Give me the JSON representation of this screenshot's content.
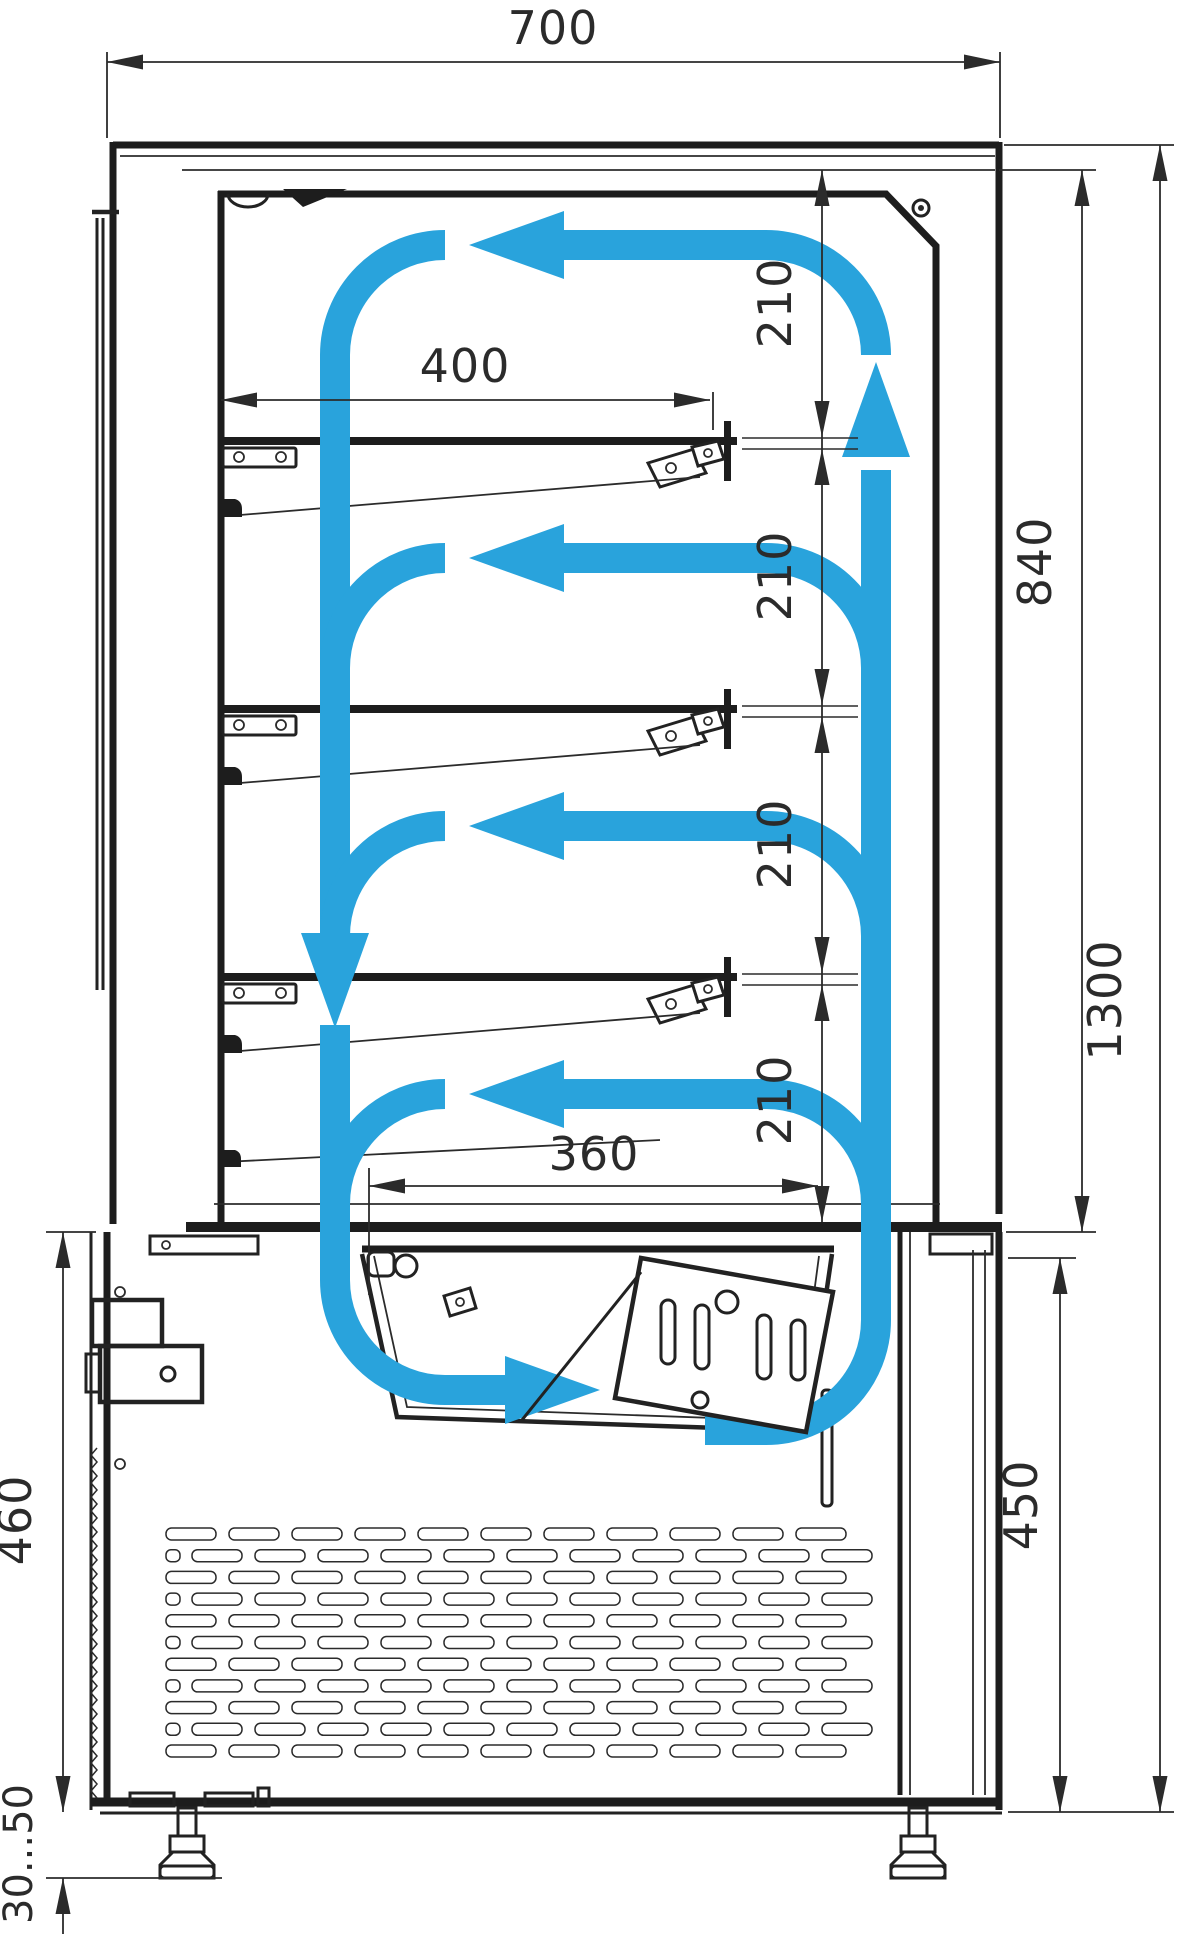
{
  "drawing": {
    "name": "refrigerated-pastry-display-case-cross-section",
    "accent_color": "#29a3dc",
    "line_color": "#2b2b2b",
    "dims": {
      "overall_width": "700",
      "shelf_depth": "400",
      "gap1": "210",
      "gap2": "210",
      "gap3": "210",
      "gap4": "210",
      "inner_height": "840",
      "overall_height": "1300",
      "deck_opening": "360",
      "base_height": "450",
      "base_height_left": "460",
      "foot_adjust_range": "30...50"
    }
  }
}
